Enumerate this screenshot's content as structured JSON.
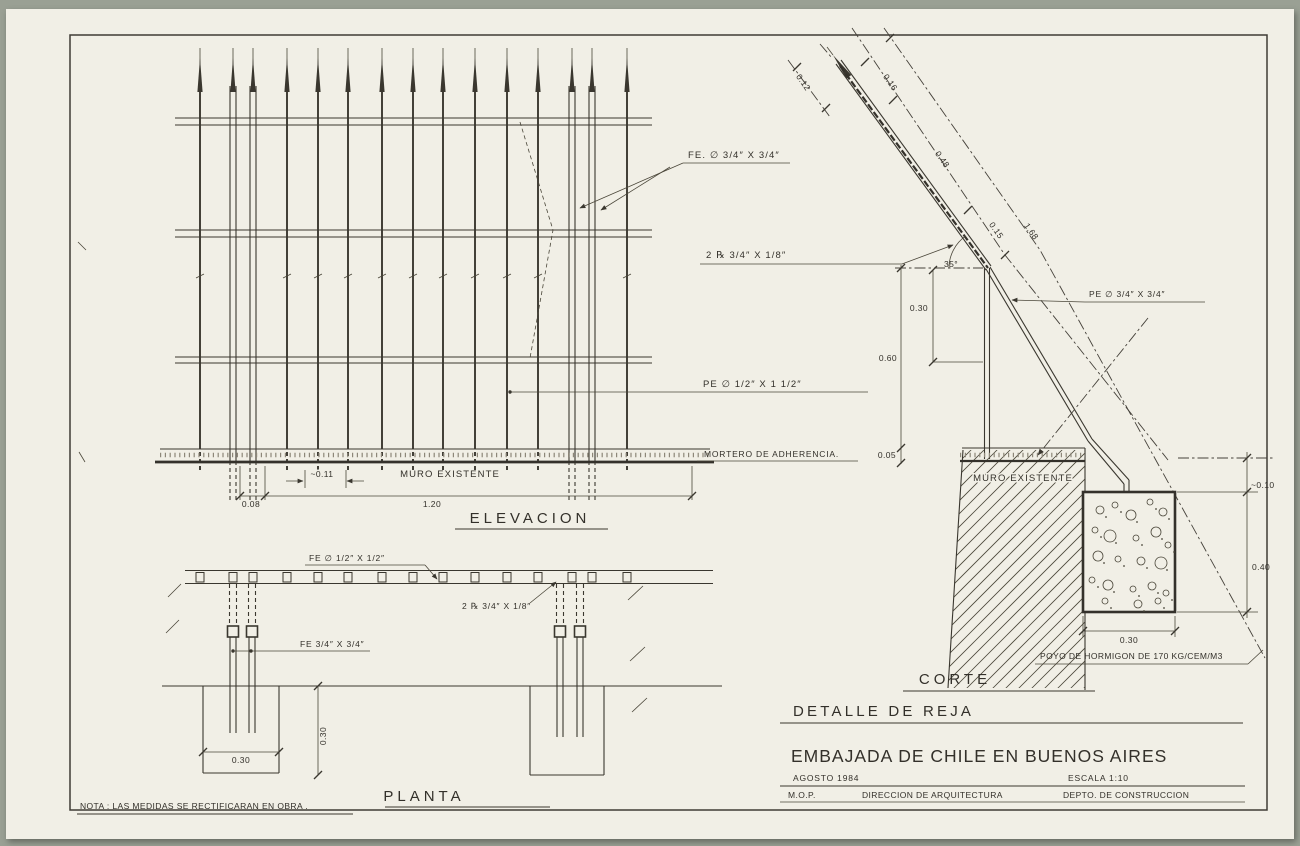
{
  "drawing": {
    "note": "NOTA : LAS MEDIDAS SE RECTIFICARAN EN OBRA .",
    "views": {
      "elevacion": {
        "title": "ELEVACION",
        "muro": "MURO EXISTENTE",
        "label_fe": "FE. ∅ 3/4″ X 3/4″",
        "label_2r": "2 ℞ 3/4″ X 1/8″",
        "label_pe": "PE ∅ 1/2″ X 1 1/2″",
        "label_mortero": "MORTERO DE ADHERENCIA.",
        "dim_008": "0.08",
        "dim_011": "~0.11",
        "dim_120": "1.20"
      },
      "planta": {
        "title": "PLANTA",
        "label_fe_half": "FE ∅ 1/2″ X 1/2″",
        "label_2r": "2 ℞ 3/4″ X 1/8″",
        "label_fe34": "FE 3/4″ X 3/4″",
        "dim_030_v": "0.30",
        "dim_030_h": "0.30"
      },
      "corte": {
        "title": "CORTE",
        "muro": "MURO EXISTENTE",
        "label_pe34": "PE ∅ 3/4″ X 3/4″",
        "label_poyo": "POYO DE HORMIGON DE 170 KG/CEM/M3",
        "angle": "35°",
        "dim_012": "0.12",
        "dim_016": "0.16",
        "dim_048": "0.48",
        "dim_015": "0.15",
        "dim_168": "1.68",
        "dim_030": "0.30",
        "dim_060": "0.60",
        "dim_005": "0.05",
        "dim_010": "~0.10",
        "dim_040": "0.40",
        "dim_030_base": "0.30"
      }
    },
    "title_block": {
      "subtitle": "DETALLE DE REJA",
      "project": "EMBAJADA DE CHILE EN BUENOS AIRES",
      "date": "AGOSTO 1984",
      "scale": "ESCALA 1:10",
      "org_left": "M.O.P.",
      "org_mid": "DIRECCION DE ARQUITECTURA",
      "org_right": "DEPTO. DE CONSTRUCCION"
    },
    "colors": {
      "ink": "#3a372f",
      "paper": "#f1efe6",
      "background": "#9aa094"
    }
  }
}
